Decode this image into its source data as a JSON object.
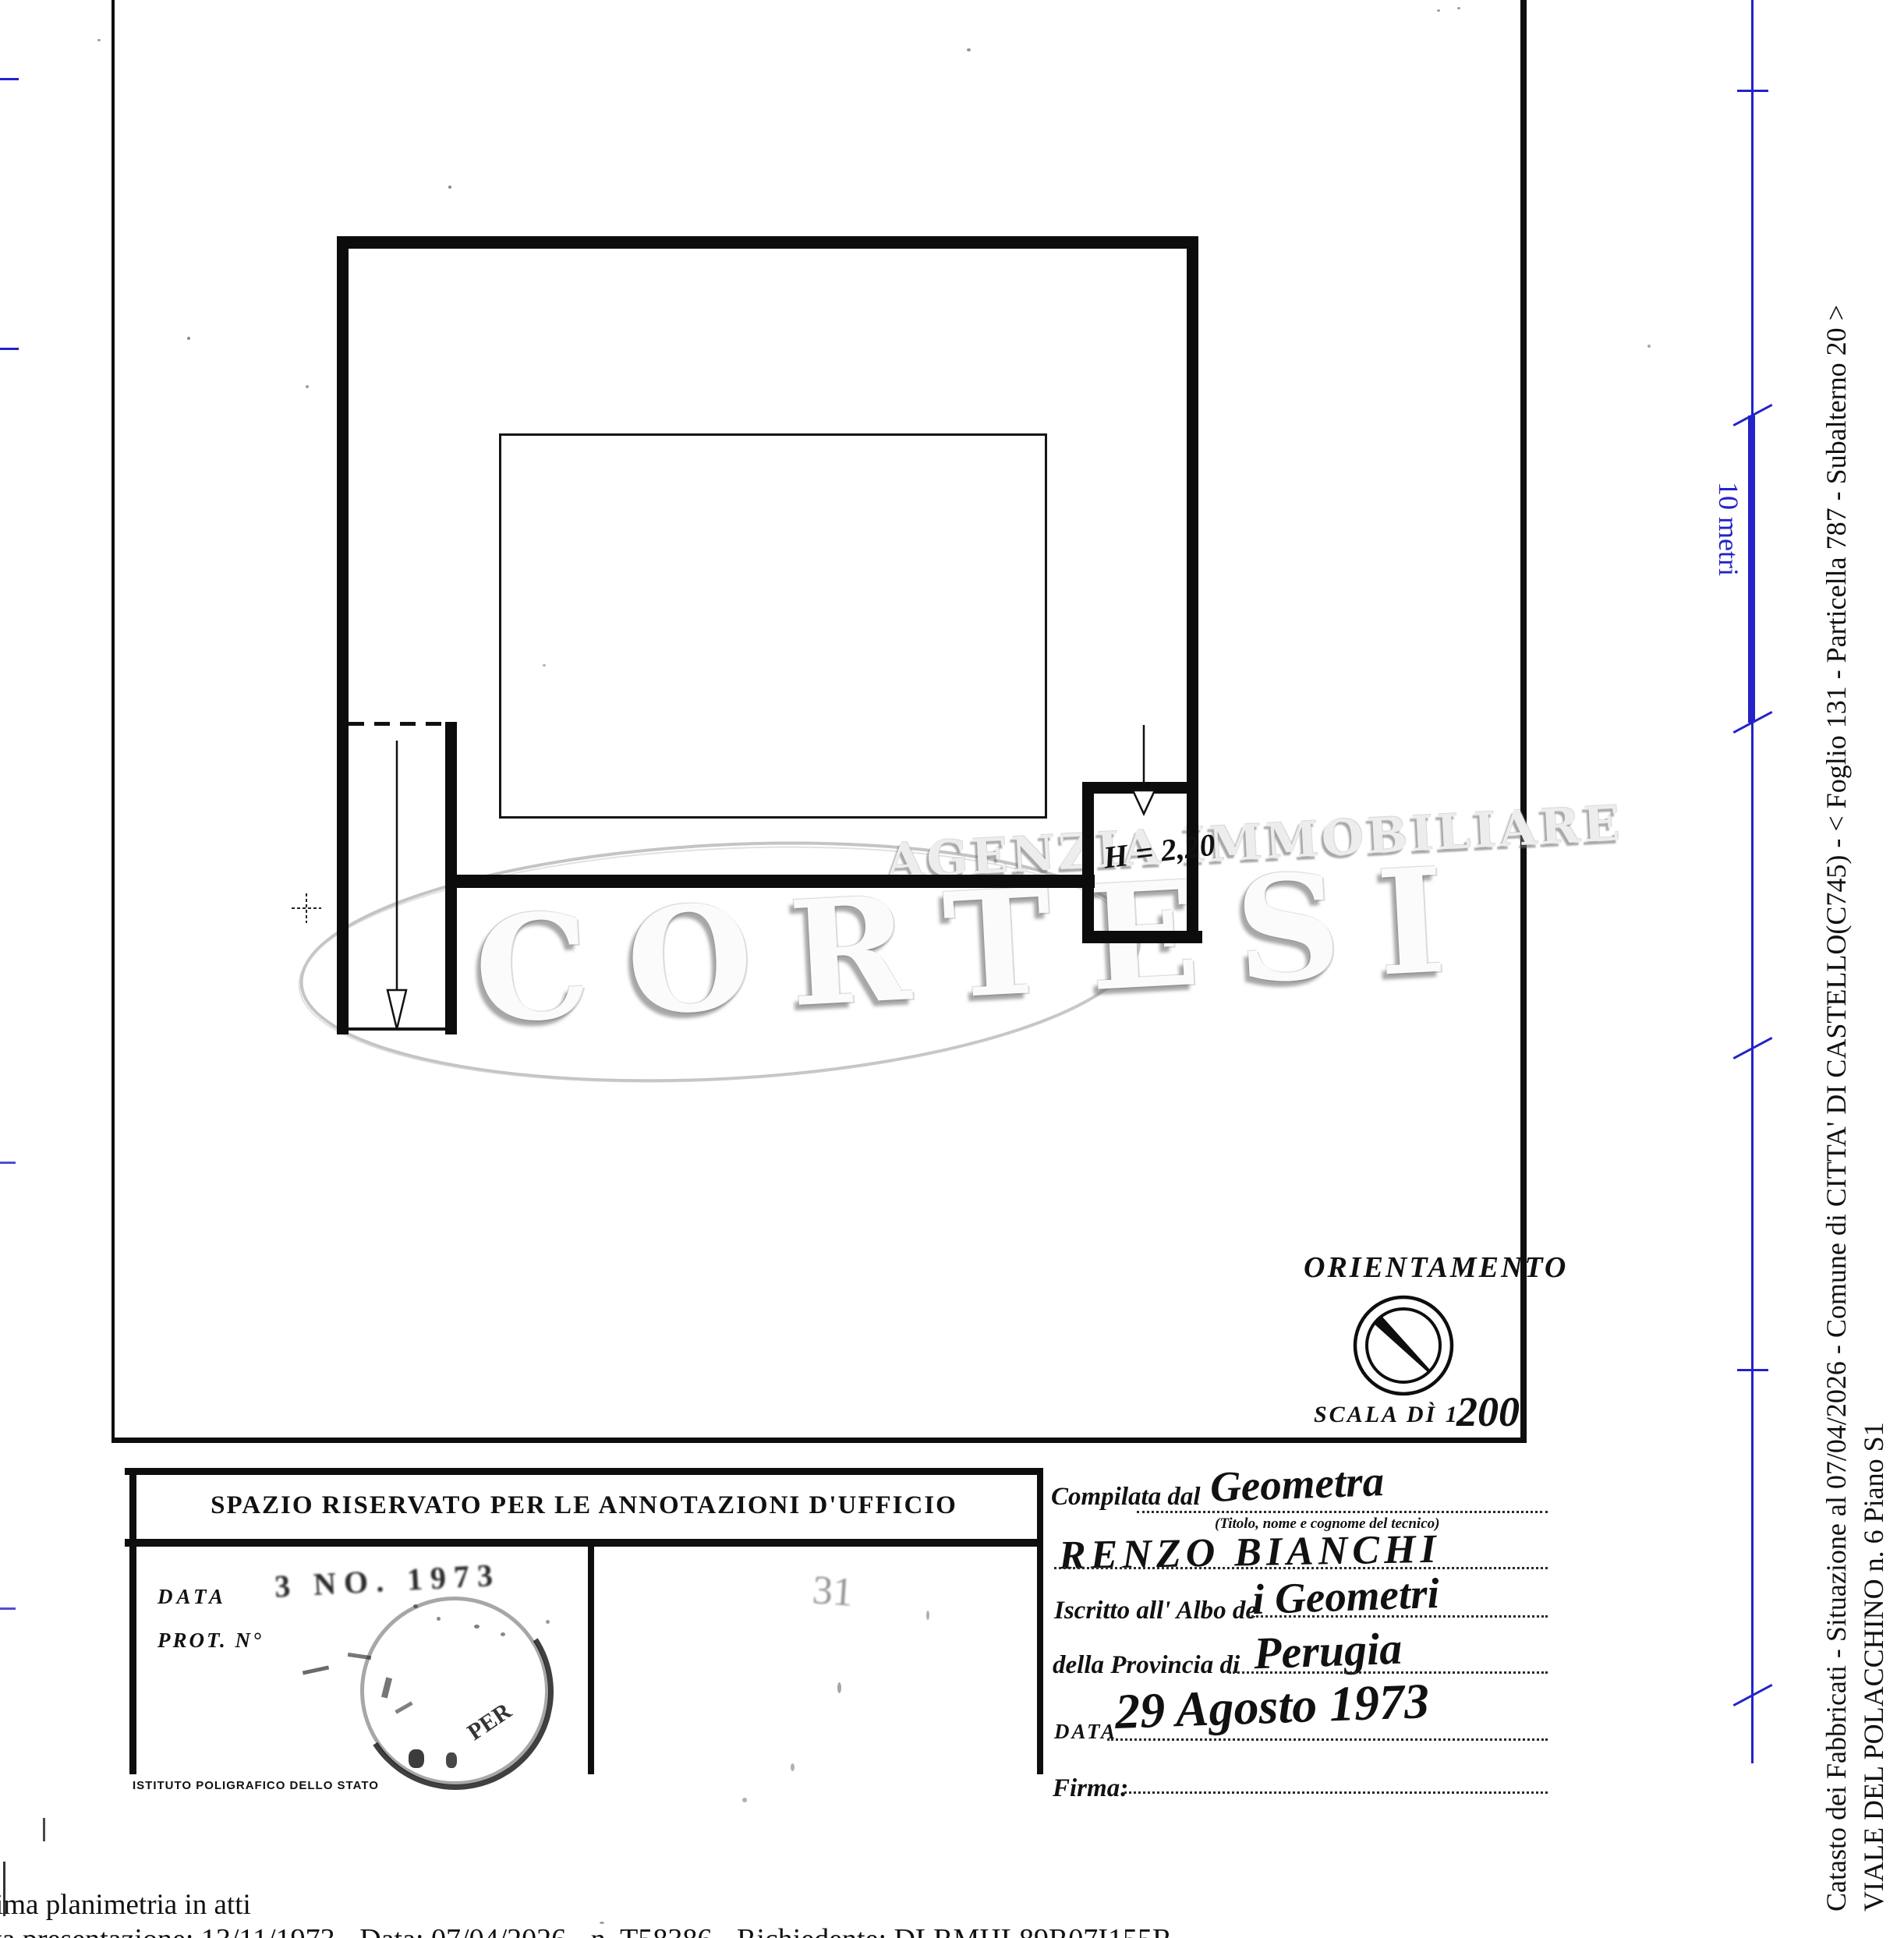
{
  "plan": {
    "height_annotation": "H = 2,20",
    "orientation": {
      "label": "ORIENTAMENTO",
      "scale_label": "SCALA DÌ 1.",
      "scale_value": "200"
    }
  },
  "watermark": {
    "line1": "AGENZIA IMMOBILIARE",
    "line2": "CORTESI"
  },
  "ruler": {
    "label": "10 metri"
  },
  "office_box": {
    "header": "SPAZIO RISERVATO PER LE ANNOTAZIONI D'UFFICIO",
    "data_label": "DATA",
    "prot_label": "PROT. N°",
    "stamp_date": "3 NO. 1973",
    "stamp_fragment": "PER",
    "stamp_number": "31",
    "printer_credit": "ISTITUTO POLIGRAFICO DELLO STATO"
  },
  "form": {
    "compilata_label": "Compilata dal",
    "compilata_value": "Geometra",
    "tecnico_hint": "(Titolo, nome e cognome del tecnico)",
    "name_value": "RENZO BIANCHI",
    "albo_label": "Iscritto all' Albo de",
    "albo_value": "i Geometri",
    "provincia_label": "della Provincia di",
    "provincia_value": "Perugia",
    "data_label": "DATA",
    "data_value": "29 Agosto 1973",
    "firma_label": "Firma:"
  },
  "sidebar": {
    "line1": "Catasto dei Fabbricati - Situazione al 07/04/2026 - Comune di CITTA' DI CASTELLO(C745) - <  Foglio 131 - Particella  787 - Subalterno 20 >",
    "line2": "VIALE DEL POLACCHINO n. 6 Piano S1"
  },
  "footer": {
    "line1": "ima planimetria in atti",
    "line2": "ta presentazione: 13/11/1973 - Data: 07/04/2026 - n. T58386 - Richiedente: DLRMHL89R07I155R"
  },
  "colors": {
    "ruler_blue": "#2323c8",
    "ink": "#111111",
    "watermark_gray": "#b0b0b0"
  }
}
